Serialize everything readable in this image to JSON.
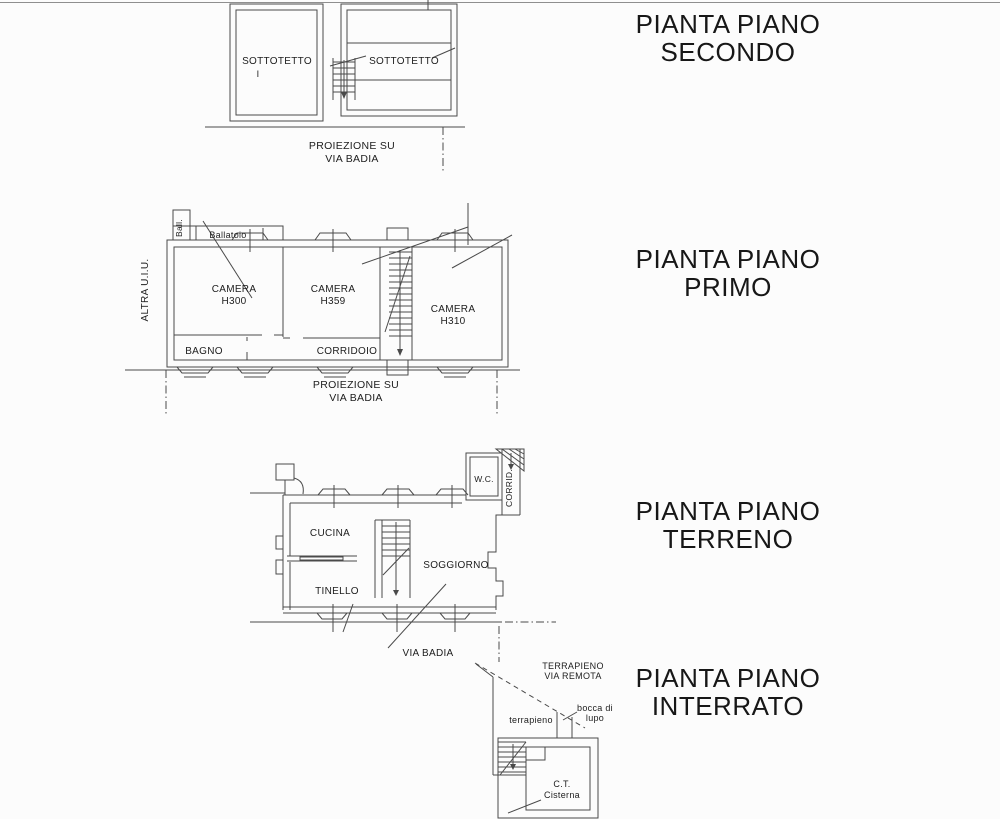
{
  "sheet": {
    "background": "#fcfcfc",
    "line_color": "#4a4a4a",
    "text_color": "#1d1d1d"
  },
  "plans": {
    "secondo": {
      "title_line1": "PIANTA PIANO",
      "title_line2": "SECONDO",
      "room_left": "SOTTOTETTO",
      "room_left_sub": "I",
      "room_right": "SOTTOTETTO",
      "caption_line1": "PROIEZIONE SU",
      "caption_line2": "VIA BADIA"
    },
    "primo": {
      "title_line1": "PIANTA PIANO",
      "title_line2": "PRIMO",
      "altra_uiu": "ALTRA U.I.U.",
      "ball": "Ball.",
      "ballatoio": "Ballatoio",
      "camera1_name": "CAMERA",
      "camera1_height": "H300",
      "camera2_name": "CAMERA",
      "camera2_height": "H359",
      "camera3_name": "CAMERA",
      "camera3_height": "H310",
      "bagno": "BAGNO",
      "corridoio": "CORRIDOIO",
      "caption_line1": "PROIEZIONE SU",
      "caption_line2": "VIA BADIA"
    },
    "terreno": {
      "title_line1": "PIANTA PIANO",
      "title_line2": "TERRENO",
      "cucina": "CUCINA",
      "tinello": "TINELLO",
      "soggiorno": "SOGGIORNO",
      "wc": "W.C.",
      "corrid": "CORRID.",
      "street": "VIA BADIA"
    },
    "interrato": {
      "title_line1": "PIANTA PIANO",
      "title_line2": "INTERRATO",
      "embankment_line1": "TERRAPIENO",
      "embankment_line2": "VIA REMOTA",
      "terrapieno": "terrapieno",
      "bocca_line1": "bocca di",
      "bocca_line2": "lupo",
      "ct_line1": "C.T.",
      "ct_line2": "Cisterna"
    }
  }
}
